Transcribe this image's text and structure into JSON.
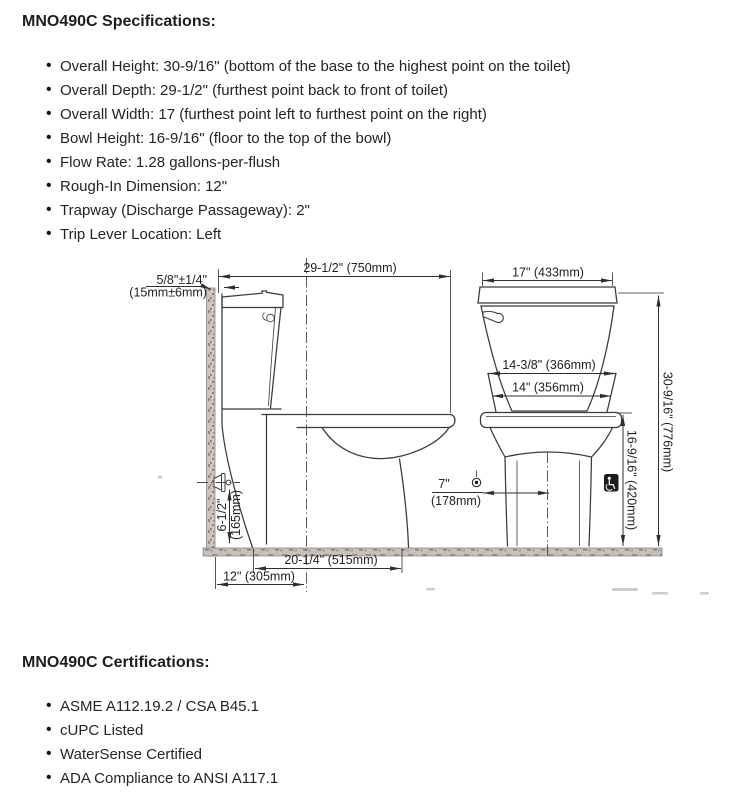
{
  "specs": {
    "heading": "MNO490C Specifications:",
    "items": [
      "Overall Height: 30-9/16\" (bottom of the base to the highest point on the toilet)",
      "Overall Depth: 29-1/2\" (furthest point back to front of toilet)",
      "Overall Width: 17 (furthest point left to furthest point on the right)",
      "Bowl Height: 16-9/16\" (floor to the top of the bowl)",
      "Flow Rate: 1.28 gallons-per-flush",
      "Rough-In Dimension: 12\"",
      "Trapway (Discharge Passageway): 2\"",
      "Trip Lever Location: Left"
    ]
  },
  "certifications": {
    "heading": "MNO490C Certifications:",
    "items": [
      "ASME A112.19.2 / CSA B45.1",
      "cUPC Listed",
      "WaterSense Certified",
      "ADA Compliance to ANSI A117.1"
    ]
  },
  "diagram": {
    "labels": {
      "wall_gap_line1": "5/8\"±1/4\"",
      "wall_gap_line2": "(15mm±6mm)",
      "overall_depth": "29-1/2\" (750mm)",
      "overall_width": "17\" (433mm)",
      "seat_width": "14-3/8\" (366mm)",
      "bowl_width": "14\" (356mm)",
      "supply_offset_in": "7\"",
      "supply_offset_mm": "(178mm)",
      "supply_height_in": "6-1/2\"",
      "supply_height_mm": "(165mm)",
      "bowl_height": "16-9/16\" (420mm)",
      "overall_height": "30-9/16\" (776mm)",
      "base_depth": "20-1/4\" (515mm)",
      "rough_in": "12\" (305mm)"
    },
    "colors": {
      "line": "#3a3a3a",
      "wall_fill": "#cbc7c0",
      "floor_fill": "#c6c2bb",
      "ada_badge_bg": "#1c1c1c"
    }
  }
}
